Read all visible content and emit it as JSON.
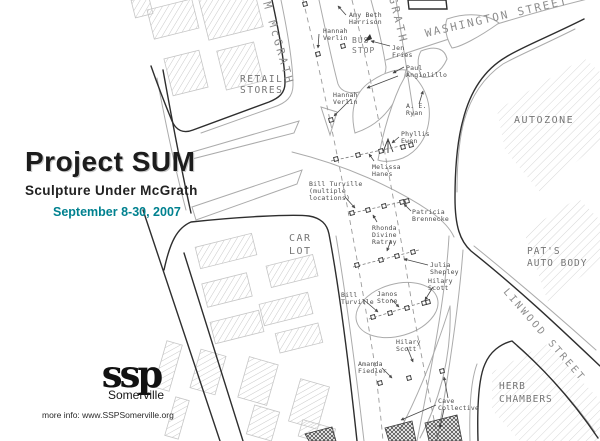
{
  "title_block": {
    "title": "Project SUM",
    "subtitle": "Sculpture Under McGrath",
    "dates": "September 8-30, 2007",
    "dates_color": "#00818F"
  },
  "footer": {
    "logo_text": "ssp",
    "logo_subtext": "Somerville",
    "more_info": "more info: www.SSPSomerville.org"
  },
  "map": {
    "street_labels": [
      {
        "text": "M McGRATH",
        "x": 263,
        "y": 3,
        "rotate": 74,
        "size": 11,
        "spacing": 3
      },
      {
        "text": "GRATH",
        "x": 389,
        "y": -2,
        "rotate": 76,
        "size": 11,
        "spacing": 3
      },
      {
        "text": "WASHINGTON STREET",
        "x": 426,
        "y": 37,
        "rotate": -13,
        "size": 11,
        "spacing": 2
      },
      {
        "text": "LINWOOD STREET",
        "x": 503,
        "y": 292,
        "rotate": 49,
        "size": 10,
        "spacing": 2.5
      }
    ],
    "place_labels": [
      {
        "lines": [
          "RETAIL",
          "STORES"
        ],
        "x": 240,
        "y": 82,
        "size": 9.5,
        "spacing": 1.5,
        "lh": 11
      },
      {
        "lines": [
          "AUTOZONE"
        ],
        "x": 514,
        "y": 123,
        "size": 10,
        "spacing": 1.5
      },
      {
        "lines": [
          "CAR",
          "LOT"
        ],
        "x": 289,
        "y": 241,
        "size": 10,
        "spacing": 1.5,
        "lh": 13
      },
      {
        "lines": [
          "PAT'S",
          "AUTO BODY"
        ],
        "x": 527,
        "y": 254,
        "size": 9.5,
        "spacing": 1,
        "lh": 12
      },
      {
        "lines": [
          "HERB",
          "CHAMBERS"
        ],
        "x": 499,
        "y": 389,
        "size": 9.5,
        "spacing": 1,
        "lh": 13
      },
      {
        "lines": [
          "BUS",
          "STOP"
        ],
        "x": 352,
        "y": 43,
        "size": 8,
        "spacing": 1,
        "lh": 10
      }
    ],
    "artist_labels": [
      {
        "lines": [
          "Amy Beth",
          "Harrison"
        ],
        "x": 349,
        "y": 17
      },
      {
        "lines": [
          "Hannah",
          "Verlin"
        ],
        "x": 323,
        "y": 33
      },
      {
        "lines": [
          "Jen",
          "Fries"
        ],
        "x": 392,
        "y": 50
      },
      {
        "lines": [
          "Paul",
          "Angiolillo"
        ],
        "x": 406,
        "y": 70
      },
      {
        "lines": [
          "Hannah",
          "Verlin"
        ],
        "x": 333,
        "y": 97
      },
      {
        "lines": [
          "A. E.",
          "Ryan"
        ],
        "x": 406,
        "y": 108
      },
      {
        "lines": [
          "Phyllis",
          "Ewen"
        ],
        "x": 401,
        "y": 136
      },
      {
        "lines": [
          "Melissa",
          "Hanes"
        ],
        "x": 372,
        "y": 169
      },
      {
        "lines": [
          "Bill Turville",
          "(multiple",
          "locations)"
        ],
        "x": 309,
        "y": 186
      },
      {
        "lines": [
          "Patricia",
          "Brennecke"
        ],
        "x": 412,
        "y": 214
      },
      {
        "lines": [
          "Rhonda",
          "Divine",
          "Ratray"
        ],
        "x": 372,
        "y": 230
      },
      {
        "lines": [
          "Julia",
          "Shepley"
        ],
        "x": 430,
        "y": 267
      },
      {
        "lines": [
          "Hilary",
          "Scott"
        ],
        "x": 428,
        "y": 283
      },
      {
        "lines": [
          "Bill",
          "Turville"
        ],
        "x": 341,
        "y": 297
      },
      {
        "lines": [
          "Janos",
          "Stone"
        ],
        "x": 377,
        "y": 296
      },
      {
        "lines": [
          "Hilary",
          "Scott"
        ],
        "x": 396,
        "y": 344
      },
      {
        "lines": [
          "Amanda",
          "Fiedler"
        ],
        "x": 358,
        "y": 366
      },
      {
        "lines": [
          "Cave",
          "Collective"
        ],
        "x": 438,
        "y": 403
      }
    ]
  }
}
